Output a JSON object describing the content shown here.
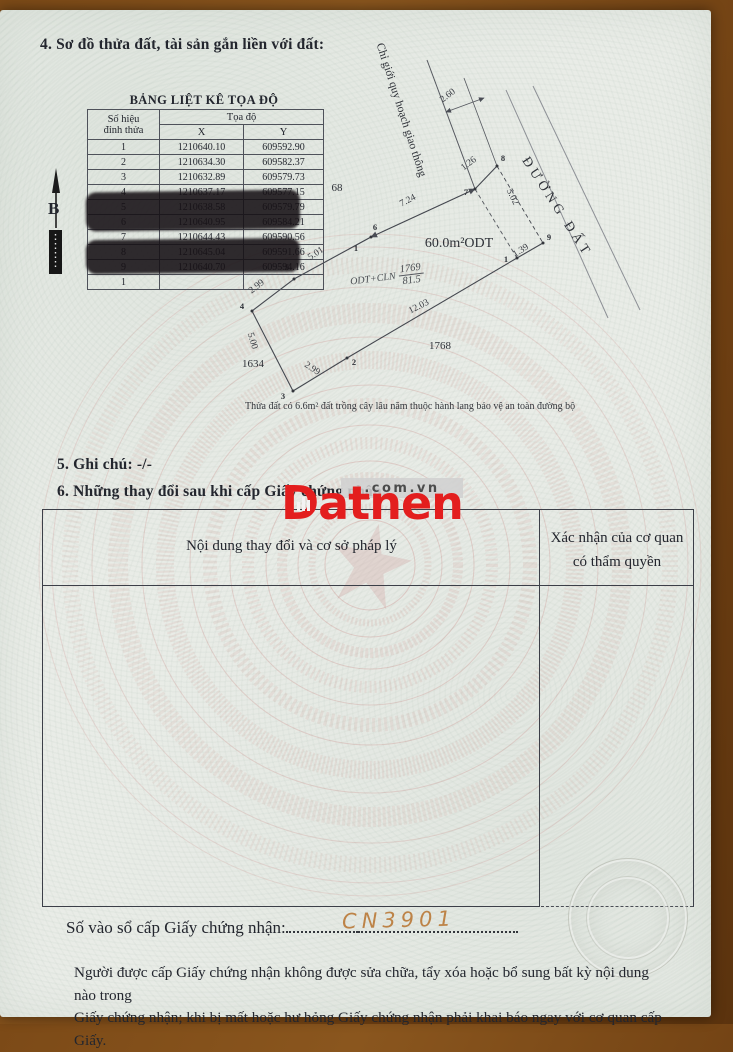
{
  "page": {
    "section4_title": "4. Sơ đồ thửa đất, tài sản gắn liền với đất:",
    "section5_title": "5. Ghi chú: -/-",
    "section6_title": "6. Những thay đổi sau khi cấp Giấy chứng nhận:",
    "register_label": "Số vào sổ cấp Giấy chứng nhận:",
    "register_number": "CN3901",
    "footer_line1": "Người được cấp Giấy chứng nhận không được sửa chữa, tẩy xóa hoặc bổ sung bất kỳ nội dung nào trong",
    "footer_line2": "Giấy chứng nhận; khi bị mất hoặc hư hỏng Giấy chứng nhận phải khai báo ngay với cơ quan cấp Giấy."
  },
  "coord_table": {
    "title": "BẢNG LIỆT KÊ TỌA ĐỘ",
    "header": {
      "col1_line1": "Số hiệu",
      "col1_line2": "đỉnh thửa",
      "span": "Tọa độ",
      "x": "X",
      "y": "Y"
    },
    "rows": [
      {
        "n": "1",
        "x": "1210640.10",
        "y": "609592.90"
      },
      {
        "n": "2",
        "x": "1210634.30",
        "y": "609582.37"
      },
      {
        "n": "3",
        "x": "1210632.89",
        "y": "609579.73"
      },
      {
        "n": "4",
        "x": "1210637.17",
        "y": "609577.15"
      },
      {
        "n": "5",
        "x": "1210638.58",
        "y": "609579.79"
      },
      {
        "n": "6",
        "x": "1210640.95",
        "y": "609584.21"
      },
      {
        "n": "7",
        "x": "1210644.43",
        "y": "609590.56"
      },
      {
        "n": "8",
        "x": "1210645.04",
        "y": "609591.66"
      },
      {
        "n": "9",
        "x": "1210640.70",
        "y": "609594.16"
      },
      {
        "n": "1",
        "x": "",
        "y": ""
      }
    ]
  },
  "compass": {
    "label": "B"
  },
  "diagram": {
    "planning_line_label": "Chỉ giới quy hoạch giao thông",
    "road_label": "ĐƯỜNG ĐẤT",
    "parcel_use": "ODT+CLN",
    "parcel_number": "1769",
    "parcel_area": "81.5",
    "area_note": "Thửa đất có 6.6m² đất trồng cây lâu năm thuộc hành lang bảo vệ an toàn đường bộ",
    "dimensions": [
      {
        "t": "2.60",
        "x": 448,
        "y": 96,
        "r": -37
      },
      {
        "t": "1.26",
        "x": 469,
        "y": 164,
        "r": -37
      },
      {
        "t": "7.24",
        "x": 408,
        "y": 201,
        "r": -28
      },
      {
        "t": "5.02",
        "x": 512,
        "y": 197,
        "r": 64
      },
      {
        "t": "1.39",
        "x": 521,
        "y": 251,
        "r": -33
      },
      {
        "t": "5.01",
        "x": 316,
        "y": 254,
        "r": -33
      },
      {
        "t": "2.99",
        "x": 257,
        "y": 287,
        "r": -38
      },
      {
        "t": "5.00",
        "x": 252,
        "y": 341,
        "r": 73
      },
      {
        "t": "2.99",
        "x": 312,
        "y": 369,
        "r": 33
      },
      {
        "t": "12.03",
        "x": 419,
        "y": 307,
        "r": -27
      }
    ],
    "vertex_points": [
      {
        "n": "1",
        "dx": 517,
        "dy": 258,
        "lx": 506,
        "ly": 259
      },
      {
        "n": "2",
        "dx": 347,
        "dy": 358,
        "lx": 354,
        "ly": 362
      },
      {
        "n": "3",
        "dx": 293,
        "dy": 391,
        "lx": 283,
        "ly": 396
      },
      {
        "n": "4",
        "dx": 252,
        "dy": 311,
        "lx": 242,
        "ly": 306
      },
      {
        "n": "5",
        "dx": 294,
        "dy": 279,
        "lx": 287,
        "ly": 267
      },
      {
        "n": "6",
        "dx": 371,
        "dy": 237,
        "lx": 375,
        "ly": 227
      },
      {
        "n": "7",
        "dx": 475,
        "dy": 189,
        "lx": 466,
        "ly": 192
      },
      {
        "n": "8",
        "dx": 497,
        "dy": 166,
        "lx": 503,
        "ly": 158
      },
      {
        "n": "9",
        "dx": 543,
        "dy": 243,
        "lx": 549,
        "ly": 237
      },
      {
        "n": "1",
        "lx": 356,
        "ly": 248
      }
    ],
    "area_labels": [
      {
        "t": "68",
        "x": 337,
        "y": 188,
        "s": 11
      },
      {
        "t": "1634",
        "x": 253,
        "y": 364,
        "s": 11
      },
      {
        "t": "1768",
        "x": 440,
        "y": 346,
        "s": 11
      },
      {
        "t": "60.0m²ODT",
        "x": 459,
        "y": 244,
        "s": 14
      }
    ]
  },
  "change_table": {
    "col1_header": "Nội dung thay đổi và cơ sở pháp lý",
    "col2_header_line1": "Xác nhận của cơ quan",
    "col2_header_line2": "có thẩm quyền"
  },
  "watermark": {
    "brand": "Datnen",
    "suffix": ".com.vn",
    "brand_color": "#e31e1e"
  }
}
